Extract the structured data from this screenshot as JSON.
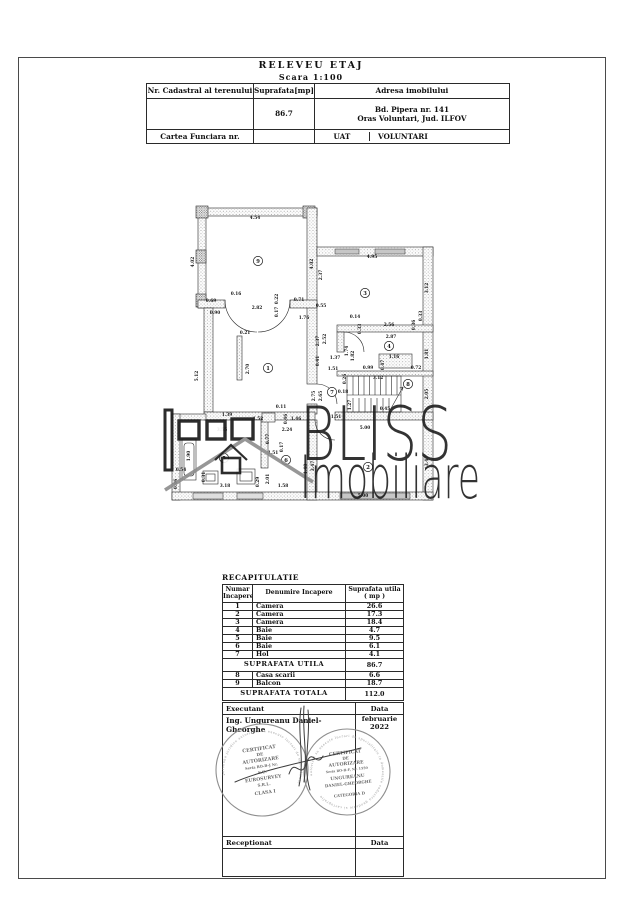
{
  "page": {
    "title": "RELEVEU ETAJ",
    "scale": "Scara 1:100"
  },
  "header_table": {
    "col1_label": "Nr. Cadastral al terenului",
    "col2_label": "Suprafata[mp]",
    "col3_label": "Adresa imobilului",
    "surface_value": "86.7",
    "address_line1": "Bd. Pipera nr. 141",
    "address_line2": "Oras Voluntari, Jud. ILFOV",
    "row3_label": "Cartea Funciara nr.",
    "uat_label": "UAT",
    "uat_value": "VOLUNTARI"
  },
  "plan": {
    "watermark_line1": "BLISS",
    "watermark_line2": "Imobiliare",
    "rooms": [
      [
        "9",
        93,
        73
      ],
      [
        "3",
        200,
        105
      ],
      [
        "1",
        103,
        180
      ],
      [
        "4",
        224,
        158
      ],
      [
        "7",
        167,
        204
      ],
      [
        "8",
        243,
        196
      ],
      [
        "6",
        121,
        272
      ],
      [
        "5",
        59,
        270
      ],
      [
        "2",
        203,
        279
      ]
    ],
    "dims": [
      [
        "4.54",
        90,
        31,
        0
      ],
      [
        "4.02",
        29,
        74,
        1
      ],
      [
        "4.02",
        148,
        76,
        1
      ],
      [
        "4.95",
        207,
        70,
        0
      ],
      [
        "2.37",
        157,
        87,
        1
      ],
      [
        "3.12",
        263,
        100,
        1
      ],
      [
        "0.69",
        46,
        114,
        0
      ],
      [
        "0.16",
        71,
        107,
        0
      ],
      [
        "0.90",
        50,
        126,
        0
      ],
      [
        "2.82",
        92,
        121,
        0
      ],
      [
        "0.17",
        113,
        124,
        1
      ],
      [
        "0.22",
        113,
        111,
        1
      ],
      [
        "0.71",
        134,
        113,
        0
      ],
      [
        "0.55",
        156,
        119,
        0
      ],
      [
        "1.76",
        139,
        131,
        0
      ],
      [
        "0.21",
        80,
        146,
        0
      ],
      [
        "2.70",
        84,
        181,
        1
      ],
      [
        "5.12",
        33,
        188,
        1
      ],
      [
        "2.37",
        154,
        153,
        1
      ],
      [
        "2.52",
        161,
        151,
        1
      ],
      [
        "0.41",
        154,
        173,
        1
      ],
      [
        "1.37",
        170,
        171,
        0
      ],
      [
        "1.51",
        168,
        182,
        0
      ],
      [
        "1.74",
        183,
        163,
        1
      ],
      [
        "1.82",
        189,
        168,
        1
      ],
      [
        "0.14",
        190,
        130,
        0
      ],
      [
        "0.33",
        196,
        141,
        1
      ],
      [
        "2.56",
        224,
        138,
        0
      ],
      [
        "2.87",
        226,
        150,
        0
      ],
      [
        "0.36",
        250,
        137,
        1
      ],
      [
        "0.33",
        257,
        128,
        1
      ],
      [
        "1.81",
        263,
        166,
        1
      ],
      [
        "1.16",
        229,
        170,
        0
      ],
      [
        "0.47",
        219,
        177,
        1
      ],
      [
        "0.99",
        203,
        181,
        0
      ],
      [
        "0.72",
        251,
        181,
        0
      ],
      [
        "0.26",
        181,
        191,
        1
      ],
      [
        "3.12",
        213,
        191,
        0
      ],
      [
        "2.05",
        263,
        206,
        1
      ],
      [
        "2.75",
        150,
        208,
        1
      ],
      [
        "2.65",
        157,
        208,
        1
      ],
      [
        "0.18",
        178,
        205,
        0
      ],
      [
        "1.27",
        186,
        217,
        1
      ],
      [
        "0.45",
        220,
        222,
        0
      ],
      [
        "5.00",
        200,
        241,
        0
      ],
      [
        "5.00",
        198,
        309,
        0
      ],
      [
        "3.47",
        263,
        273,
        1
      ],
      [
        "3.47",
        149,
        278,
        1
      ],
      [
        "1.40",
        142,
        281,
        1
      ],
      [
        "1.39",
        62,
        228,
        0
      ],
      [
        "3.55",
        57,
        243,
        0
      ],
      [
        "0.11",
        116,
        220,
        0
      ],
      [
        "0.46",
        122,
        231,
        1
      ],
      [
        "1.52",
        93,
        232,
        0
      ],
      [
        "1.46",
        131,
        232,
        0
      ],
      [
        "1.51",
        171,
        230,
        0
      ],
      [
        "2.24",
        122,
        243,
        0
      ],
      [
        "0.77",
        104,
        251,
        1
      ],
      [
        "0.17",
        118,
        259,
        1
      ],
      [
        "1.51",
        108,
        266,
        0
      ],
      [
        "2.01",
        104,
        291,
        1
      ],
      [
        "0.29",
        94,
        294,
        1
      ],
      [
        "3.18",
        60,
        299,
        0
      ],
      [
        "1.58",
        118,
        299,
        0
      ],
      [
        "1.90",
        25,
        268,
        1
      ],
      [
        "0.54",
        16,
        283,
        0
      ],
      [
        "0.86",
        12,
        296,
        1
      ],
      [
        "0.31",
        40,
        289,
        1
      ]
    ]
  },
  "recap": {
    "section_title": "RECAPITULATIE",
    "h_num_1": "Numar",
    "h_num_2": "Incapere",
    "h_name": "Denumire Incapere",
    "h_area_1": "Suprafata utila",
    "h_area_2": "( mp )",
    "rows_main": [
      {
        "num": "1",
        "name": "Camera",
        "area": "26.6"
      },
      {
        "num": "2",
        "name": "Camera",
        "area": "17.3"
      },
      {
        "num": "3",
        "name": "Camera",
        "area": "18.4"
      },
      {
        "num": "4",
        "name": "Baie",
        "area": "4.7"
      },
      {
        "num": "5",
        "name": "Baie",
        "area": "9.5"
      },
      {
        "num": "6",
        "name": "Baie",
        "area": "6.1"
      },
      {
        "num": "7",
        "name": "Hol",
        "area": "4.1"
      }
    ],
    "utila_label": "SUPRAFATA UTILA",
    "utila_value": "86.7",
    "rows_extra": [
      {
        "num": "8",
        "name": "Casa scarii",
        "area": "6.6"
      },
      {
        "num": "9",
        "name": "Balcon",
        "area": "18.7"
      }
    ],
    "totala_label": "SUPRAFATA TOTALA",
    "totala_value": "112.0"
  },
  "exec": {
    "executant_label": "Executant",
    "data_label": "Data",
    "name": "Ing. Ungureanu Daniel-Gheorghe",
    "date_line1": "februarie",
    "date_line2": "2022",
    "receptionat_label": "Receptionat"
  },
  "stamps": {
    "left": {
      "ring": "persoana juridica autorizata sa execute lucrari de specialitate",
      "lines": [
        [
          "CERTIFICAT",
          -20,
          4.8
        ],
        [
          "DE",
          -14.5,
          4.2
        ],
        [
          "AUTORIZARE",
          -8.5,
          4.8
        ],
        [
          "Seria RO-B-J Nr.",
          -2.5,
          3.6
        ],
        [
          "S.C.",
          3.5,
          4
        ],
        [
          "EUROSURVEY",
          10,
          4.6
        ],
        [
          "S.R.L.",
          16,
          4
        ],
        [
          "CLASA I",
          24,
          4.6
        ]
      ]
    },
    "right": {
      "ring": "autorizat sa execute lucrari de specialitate in domeniile cadastru geodezie si cartografie",
      "lines": [
        [
          "CERTIFICAT",
          -18,
          4.6
        ],
        [
          "DE",
          -12.5,
          4
        ],
        [
          "AUTORIZARE",
          -7,
          4.6
        ],
        [
          "Seria RO-B-F, Nr. 1550",
          -1,
          3.3
        ],
        [
          "UNGUREANU",
          6.5,
          4.5
        ],
        [
          "DANIEL-GHEORGHE",
          13,
          4
        ],
        [
          "CATEGORIA D",
          24,
          3.9
        ]
      ]
    }
  }
}
